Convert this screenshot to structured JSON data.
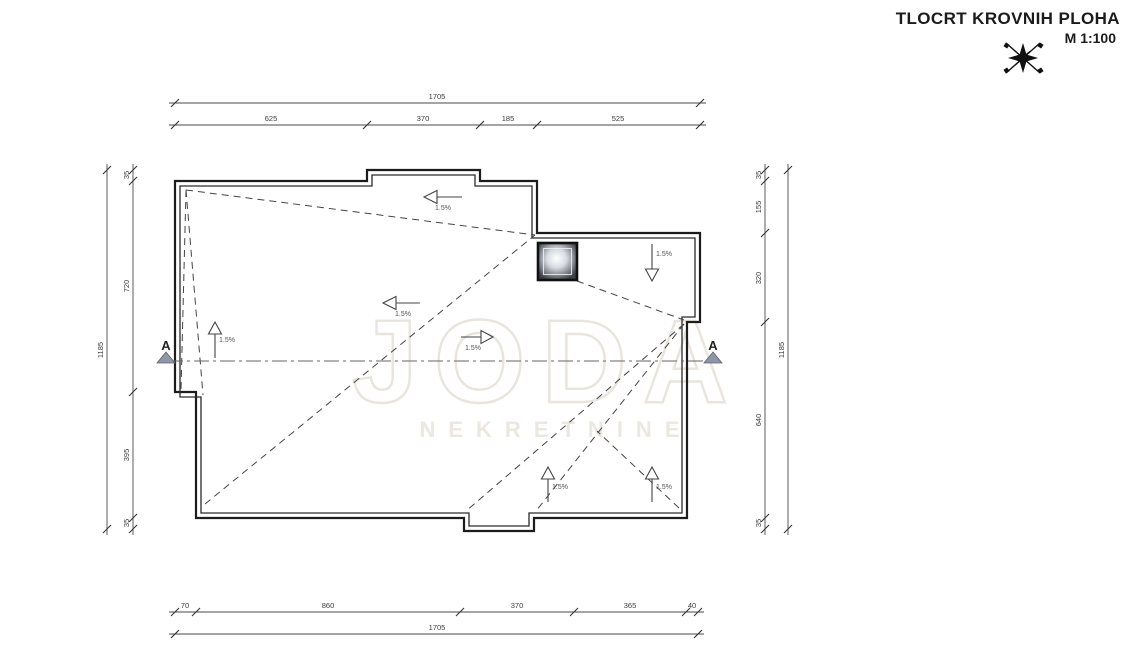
{
  "title": {
    "text": "TLOCRT KROVNIH PLOHA",
    "scale": "M 1:100"
  },
  "compass": {
    "icon": "north-star-compass"
  },
  "watermark": {
    "logo": "JODA",
    "subtitle": "NEKRETNINE"
  },
  "section": {
    "left_label": "A",
    "right_label": "A"
  },
  "slopes": {
    "arrows": [
      {
        "direction": "left",
        "location": "top-center",
        "label": "1.5%"
      },
      {
        "direction": "down",
        "location": "upper-right",
        "label": "1.5%"
      },
      {
        "direction": "left",
        "location": "center-left",
        "label": "1.5%"
      },
      {
        "direction": "right",
        "location": "center",
        "label": "1.5%"
      },
      {
        "direction": "up",
        "location": "left",
        "label": "1.5%"
      },
      {
        "direction": "up",
        "location": "bottom-center",
        "label": "1.5%"
      },
      {
        "direction": "up",
        "location": "bottom-right",
        "label": "1.5%"
      }
    ]
  },
  "dimensions": {
    "top": {
      "overall": "1705",
      "segments": [
        "625",
        "370",
        "185",
        "525"
      ]
    },
    "bottom": {
      "overall": "1705",
      "segments": [
        "70",
        "860",
        "370",
        "365",
        "40"
      ]
    },
    "left": {
      "overall": "1185",
      "segments": [
        "35",
        "720",
        "395",
        "35"
      ]
    },
    "right": {
      "overall": "1185",
      "segments": [
        "35",
        "155",
        "320",
        "640",
        "35"
      ]
    }
  },
  "colors": {
    "line": "#1c1c1c",
    "dimension": "#3a3a3a",
    "section_marker": "#8e96a8",
    "watermark": "#e9e5de"
  }
}
